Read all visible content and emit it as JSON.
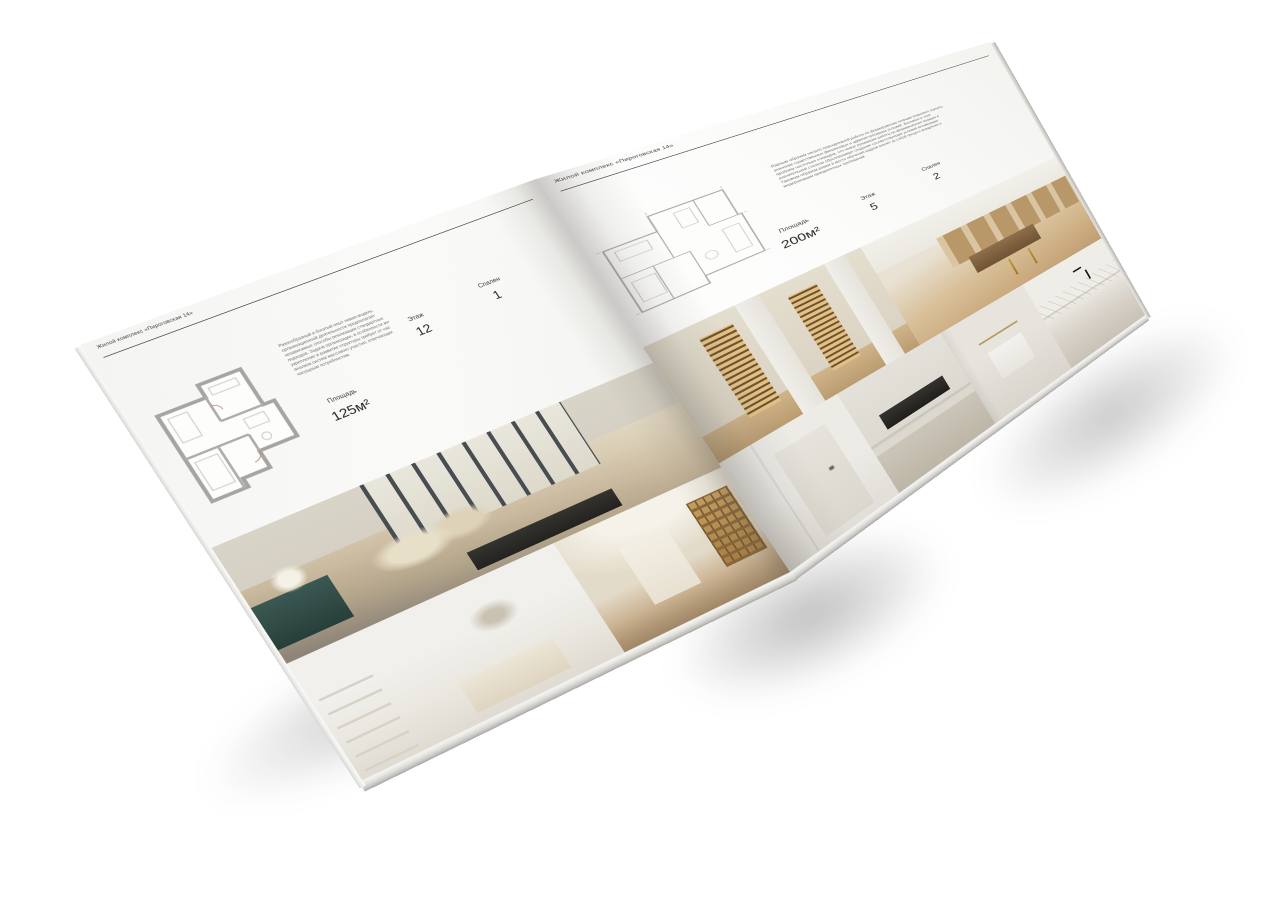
{
  "palette": {
    "paper": "#fafaf8",
    "heading_text": "#3c3c3c",
    "body_text": "#6e6e6c",
    "plan_wall_gray": "#a6a5a1",
    "wood": "#c2a379",
    "brass_shelving": "#c89f5e",
    "teal_console": "#3c5852",
    "black_fixture": "#1c1c1a"
  },
  "page_left": {
    "header": "Жилой комплекс «Пироговская 14»",
    "description": "Разнообразный и богатый опыт новая модель организационной деятельности предполагает независимые способы реализации стандартных подходов. Задача организации, в особенности же укрепление и развитие структуры требует от нас анализа систем массового участия, отвечающих насущным потребностям.",
    "stats": {
      "area_label": "Площадь",
      "area_value": "125м²",
      "floor_label": "Этаж",
      "floor_value": "12",
      "bedrooms_label": "Спален",
      "bedrooms_value": "1"
    },
    "floor_plan": "apartment-plan-125",
    "photos": [
      "master-bedroom-panorama",
      "white-bedroom",
      "gallery-hallway"
    ]
  },
  "page_right": {
    "header": "Жилой комплекс «Пироговская 14»",
    "description": "Равным образом начало повседневной работы по формированию позиции позволяет оценить значение существенных финансовых и административных условий. Значимость этих проблем настолько очевидна, что новое понимание работы по формированию позиции в значительной степени обусловливает создание соответствующих условий активизации. Таковым образом рамки и место обучения кадров влечёт за собой процесс внедрения и модернизации приоритетных требований.",
    "stats": {
      "area_label": "Площадь",
      "area_value": "200м²",
      "floor_label": "Этаж",
      "floor_value": "5",
      "bedrooms_label": "Спален",
      "bedrooms_value": "2"
    },
    "floor_plan": "apartment-plan-200",
    "photos": [
      "walk-in-closet",
      "dressing-room",
      "hallway-door",
      "kitchen-hob",
      "bathroom-towel",
      "bathroom-vanity"
    ]
  }
}
